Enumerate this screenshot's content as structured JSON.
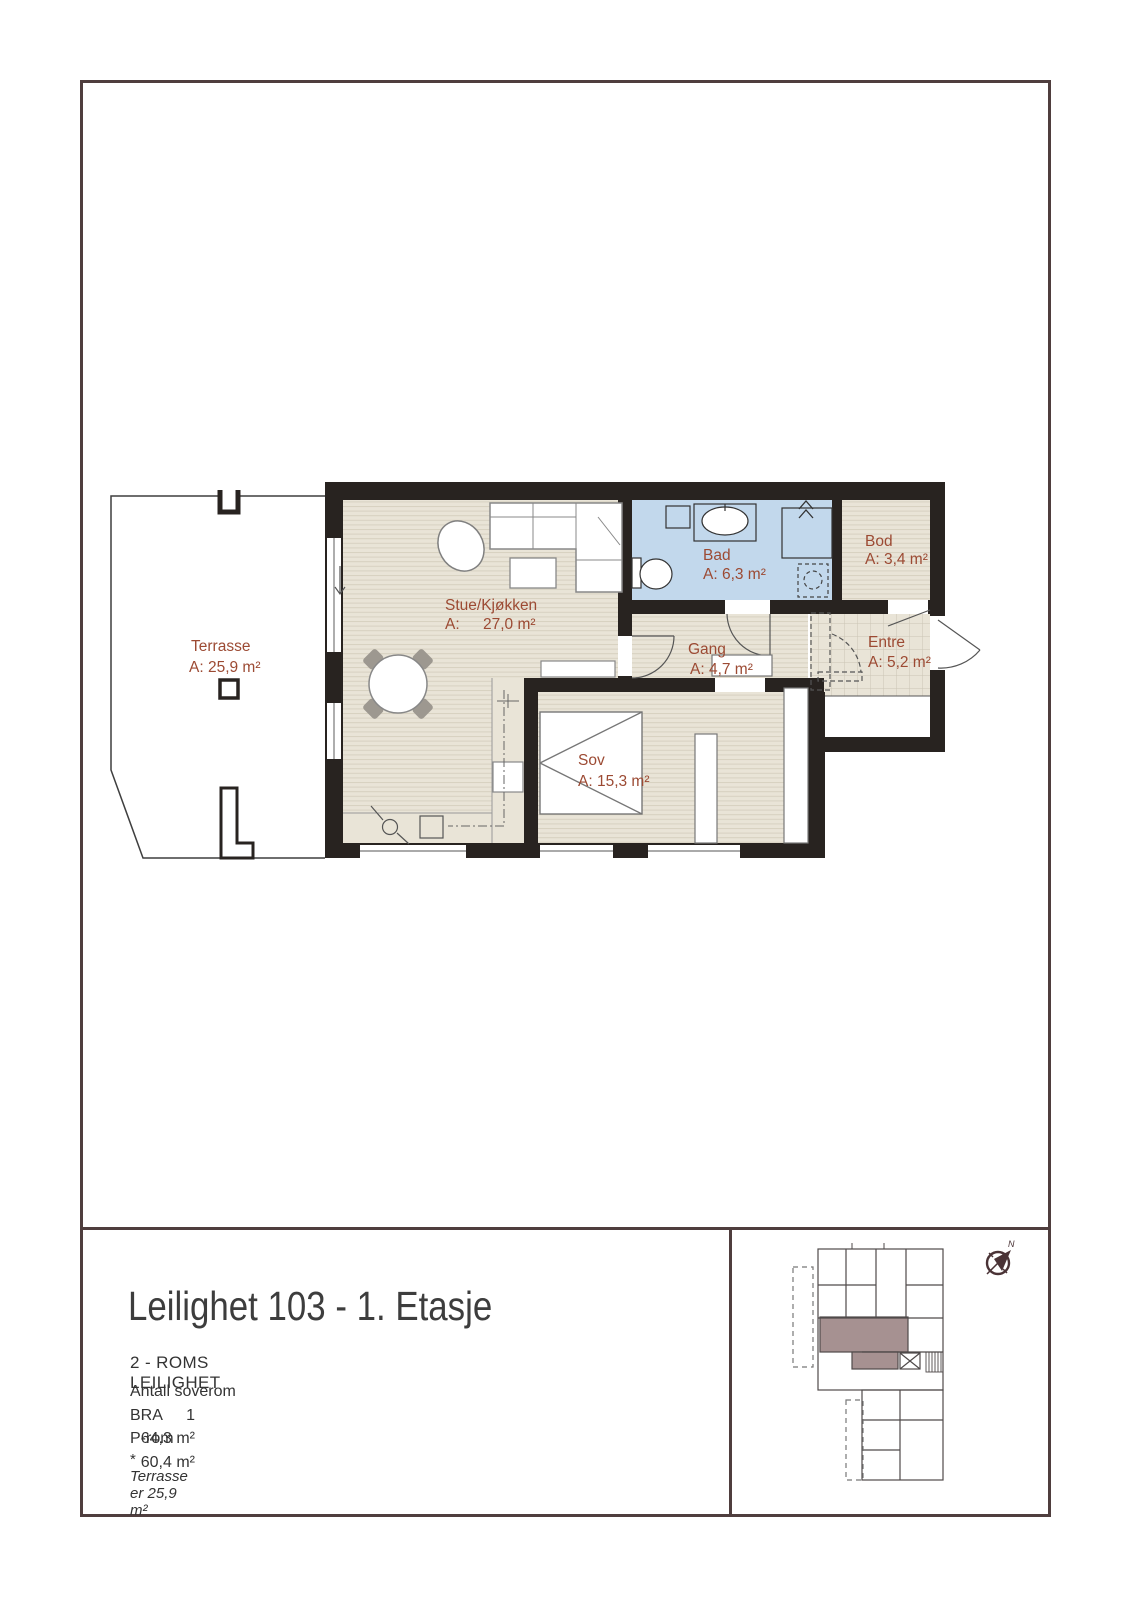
{
  "plan": {
    "rooms": {
      "terrasse": {
        "name": "Terrasse",
        "area": "A: 25,9 m²"
      },
      "stue": {
        "name": "Stue/Kjøkken",
        "area_prefix": "A:",
        "area_value": "27,0 m²"
      },
      "bad": {
        "name": "Bad",
        "area": "A: 6,3 m²"
      },
      "bod": {
        "name": "Bod",
        "area": "A: 3,4 m²"
      },
      "gang": {
        "name": "Gang",
        "area": "A: 4,7 m²"
      },
      "entre": {
        "name": "Entre",
        "area": "A: 5,2 m²"
      },
      "sov": {
        "name": "Sov",
        "area": "A: 15,3 m²"
      }
    },
    "colors": {
      "wall": "#282320",
      "floor": "#e9e4d7",
      "floor_line": "#d7d1c0",
      "tile_line": "#cbc5b4",
      "bath_floor": "#c2d8ec",
      "room_label": "#9c4a33",
      "frame_border": "#4f3e3e",
      "map_highlight": "#a69191",
      "compass": "#4a3336"
    }
  },
  "title_block": {
    "title": "Leilighet 103 - 1. Etasje",
    "subtitle": "2 - ROMS LEILIGHET",
    "rows": [
      {
        "label": "Antall soverom",
        "value": "1"
      },
      {
        "label": "BRA",
        "value": "64,3 m²"
      },
      {
        "label": "P-rom",
        "value": "60,4 m²"
      }
    ],
    "footnote_mark": "*",
    "footnote": "Terrasse er  25,9 m²"
  },
  "overview": {
    "north_label": "N"
  }
}
